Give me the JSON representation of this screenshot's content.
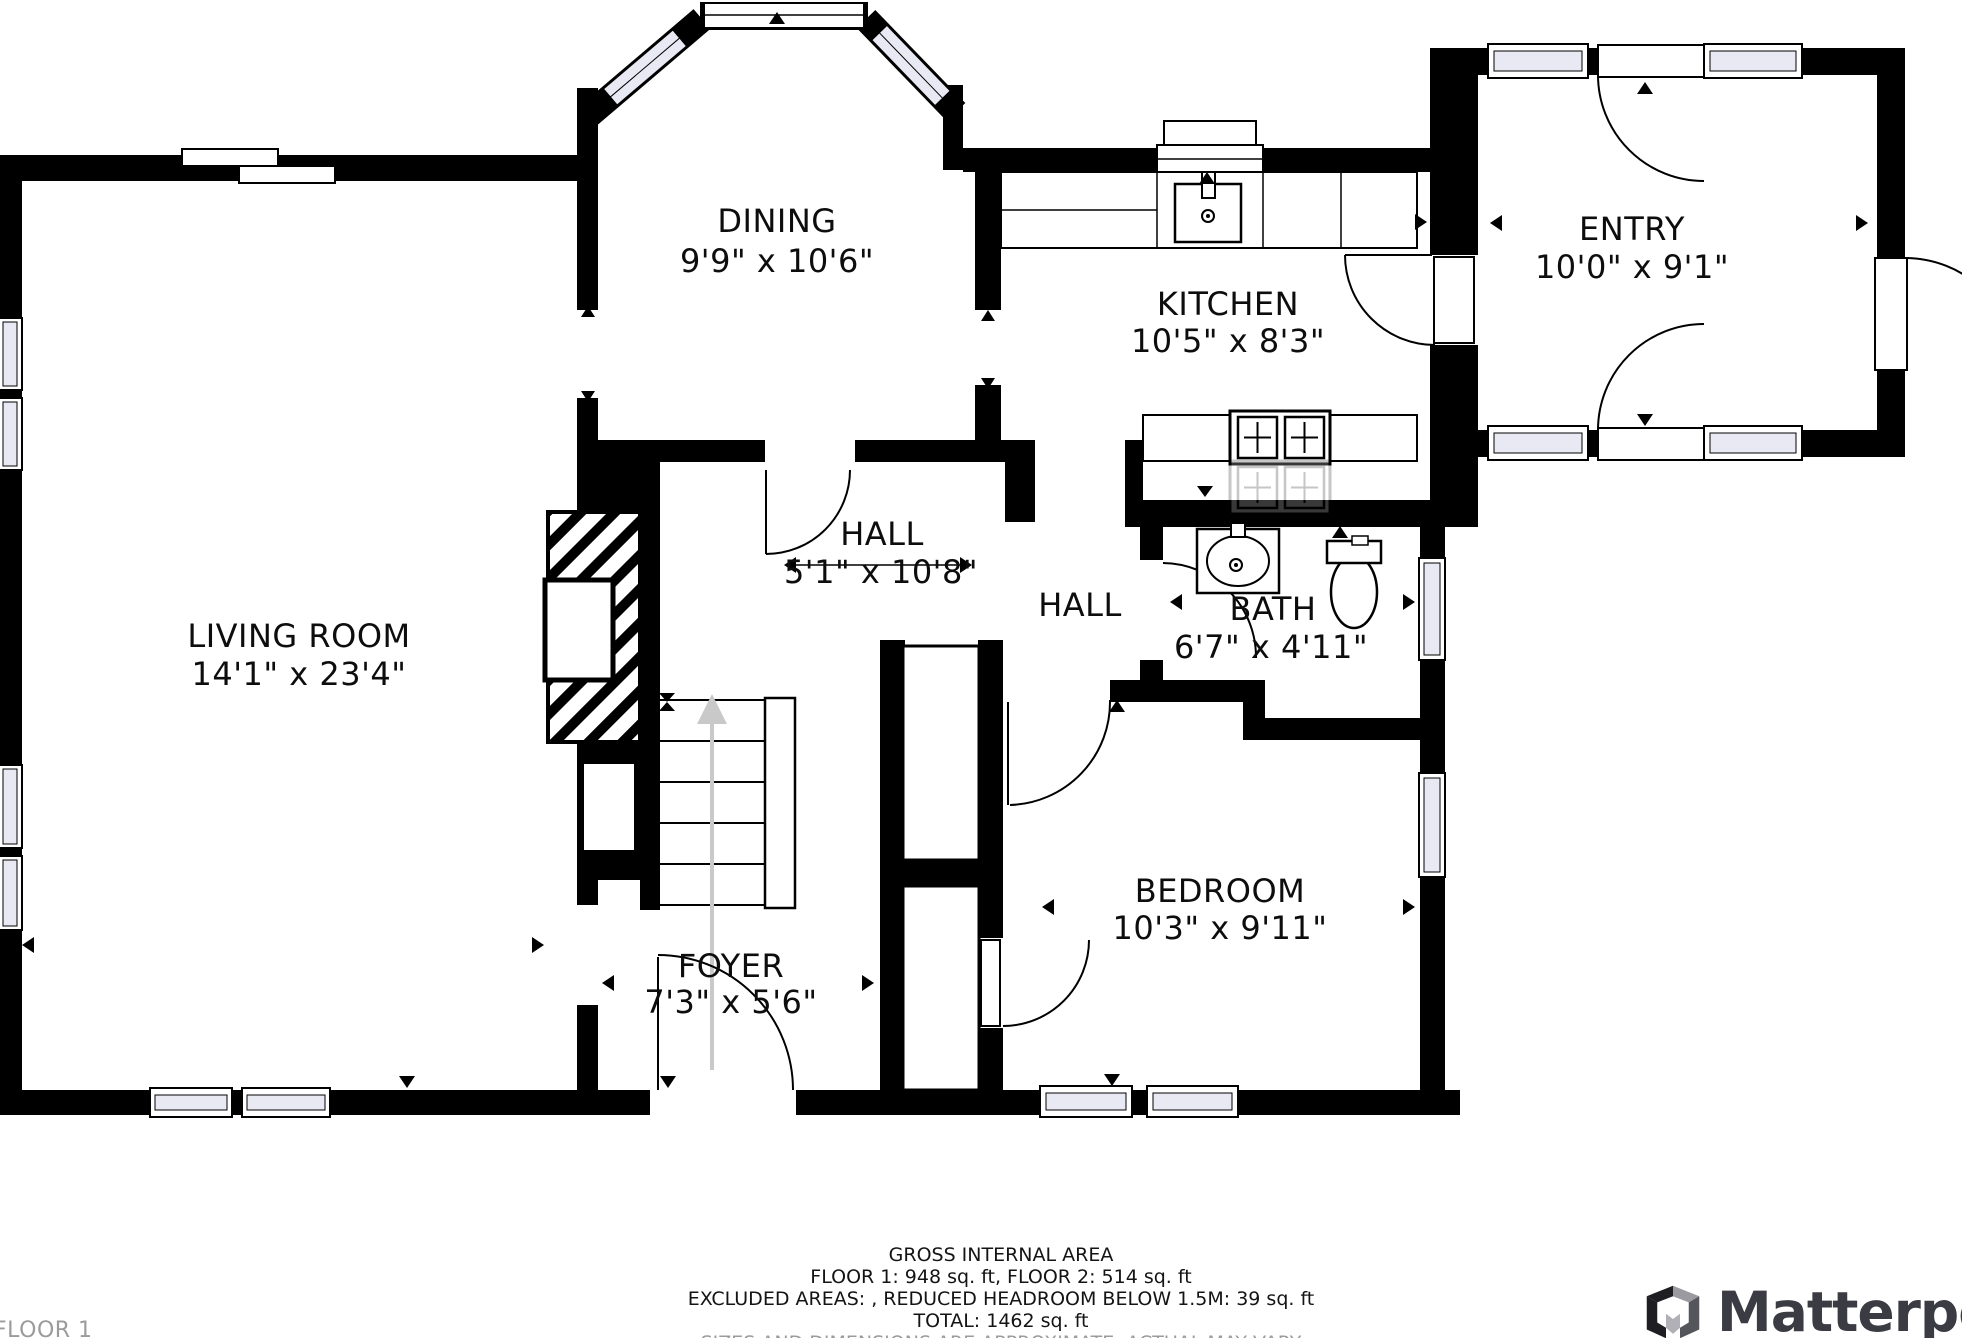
{
  "plan": {
    "floor_label": "FLOOR 1",
    "rooms": {
      "dining": {
        "name": "DINING",
        "dims": "9'9\" x 10'6\""
      },
      "kitchen": {
        "name": "KITCHEN",
        "dims": "10'5\" x 8'3\""
      },
      "entry": {
        "name": "ENTRY",
        "dims": "10'0\" x 9'1\""
      },
      "living_room": {
        "name": "LIVING ROOM",
        "dims": "14'1\" x 23'4\""
      },
      "hall_main": {
        "name": "HALL",
        "dims": "5'1\" x 10'8\""
      },
      "hall_small": {
        "name": "HALL"
      },
      "bath": {
        "name": "BATH",
        "dims": "6'7\" x 4'11\""
      },
      "bedroom": {
        "name": "BEDROOM",
        "dims": "10'3\" x 9'11\""
      },
      "foyer": {
        "name": "FOYER",
        "dims": "7'3\" x 5'6\""
      }
    }
  },
  "footer": {
    "gross_area": "GROSS INTERNAL AREA",
    "floors": "FLOOR 1: 948 sq. ft, FLOOR 2: 514 sq. ft",
    "excluded": "EXCLUDED AREAS: , REDUCED HEADROOM BELOW 1.5M: 39 sq. ft",
    "total": "TOTAL: 1462 sq. ft",
    "disclaimer": "SIZES AND DIMENSIONS ARE APPROXIMATE, ACTUAL MAY VARY"
  },
  "brand": {
    "name": "Matterport"
  },
  "colors": {
    "wall": "#000000",
    "window_glass": "#e9e9f3",
    "stair_arrow": "#c9c9c9",
    "muted_text": "#9b9b9b",
    "brand_text": "#3b3b43"
  }
}
